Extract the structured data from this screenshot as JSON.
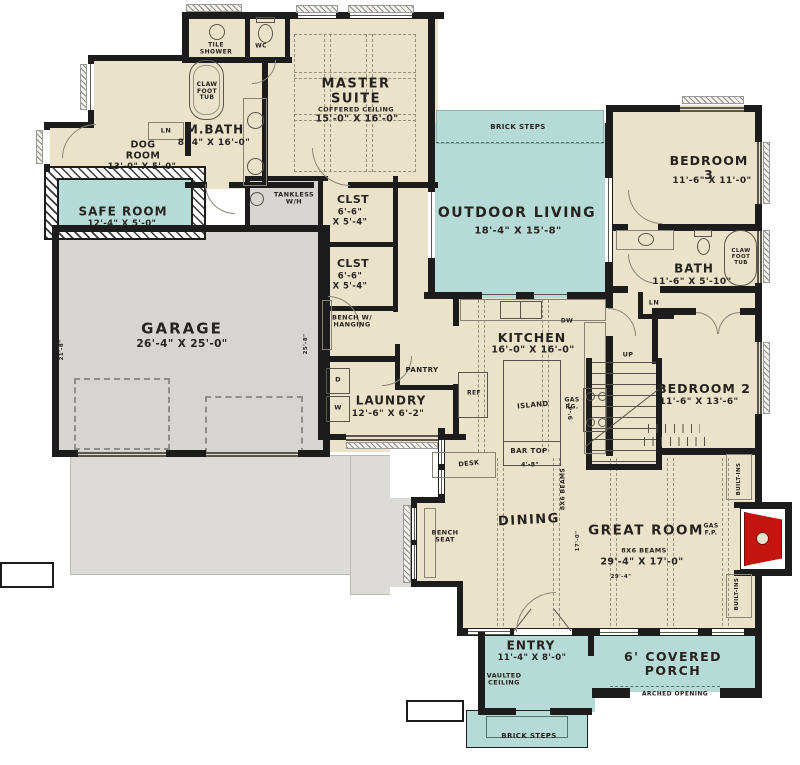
{
  "title": "House floor plan",
  "colors": {
    "interior": "#ebe3c9",
    "outdoor": "#b6dad5",
    "garage": "#d6d5d1",
    "driveway": "#dcdbd7",
    "wall": "#1c1c1c",
    "fireplace_red": "#c41410"
  },
  "rooms": {
    "master_suite": {
      "name": "MASTER\nSUITE",
      "note": "COFFERED CEILING",
      "dims": "15'-0\" X 16'-0\""
    },
    "m_bath": {
      "name": "M.BATH",
      "dims": "8'-4\" X 16'-0\""
    },
    "dog_room": {
      "name": "DOG\nROOM",
      "dims": "13'-0\" X 5'-0\""
    },
    "safe_room": {
      "name": "SAFE ROOM",
      "dims": "12'-4\" X 5'-0\""
    },
    "garage": {
      "name": "GARAGE",
      "dims": "26'-4\" X 25'-0\""
    },
    "outdoor_living": {
      "name": "OUTDOOR LIVING",
      "dims": "18'-4\" X 15'-8\""
    },
    "bedroom_3": {
      "name": "BEDROOM 3",
      "dims": "11'-6\" X 11'-0\""
    },
    "bath": {
      "name": "BATH",
      "dims": "11'-6\" X 5'-10\""
    },
    "bedroom_2": {
      "name": "BEDROOM 2",
      "dims": "11'-6\" X 13'-6\""
    },
    "kitchen": {
      "name": "KITCHEN",
      "dims": "16'-0\" X 16'-0\""
    },
    "laundry": {
      "name": "LAUNDRY",
      "dims": "12'-6\" X 6'-2\""
    },
    "pantry": {
      "name": "PANTRY"
    },
    "closet_1": {
      "name": "CLST",
      "dims": "6'-6\"\nX 5'-4\""
    },
    "closet_2": {
      "name": "CLST",
      "dims": "6'-6\"\nX 5'-4\""
    },
    "dining": {
      "name": "DINING"
    },
    "great_room": {
      "name": "GREAT ROOM",
      "note": "8X6 BEAMS",
      "dims": "29'-4\" X 17'-0\""
    },
    "entry": {
      "name": "ENTRY",
      "dims": "11'-4\" X 8'-0\"",
      "note": "VAULTED\nCEILING"
    },
    "porch": {
      "name": "6' COVERED PORCH",
      "note": "ARCHED OPENING"
    }
  },
  "features": {
    "tile_shower": "TILE\nSHOWER",
    "wc": "WC",
    "claw_tub_master": "CLAW\nFOOT\nTUB",
    "claw_tub_bath": "CLAW\nFOOT\nTUB",
    "tankless": "TANKLESS\nW/H",
    "linen_1": "LN",
    "linen_2": "LN",
    "up": "UP",
    "bench_hanging": "BENCH W/\nHANGING",
    "bench_seat": "BENCH\nSEAT",
    "desk": "DESK",
    "island": "ISLAND",
    "bar_top": "BAR TOP",
    "ref": "REF",
    "gas_range": "GAS\nRG.",
    "dishwasher": "DW",
    "washer": "W",
    "dryer": "D",
    "gas_fireplace": "GAS\nF.P.",
    "built_ins_1": "BUILT-INS",
    "built_ins_2": "BUILT-INS",
    "beams": "8X6 BEAMS",
    "brick_steps_top": "BRICK STEPS",
    "brick_steps_bottom": "BRICK STEPS"
  },
  "dims": {
    "island_width": "4'-8\"",
    "island_depth": "9'-4\"",
    "great_room_width": "29'-4\"",
    "great_room_depth": "17'-0\"",
    "garage_side_left": "21'-8\"",
    "garage_side_right": "25'-8\""
  }
}
